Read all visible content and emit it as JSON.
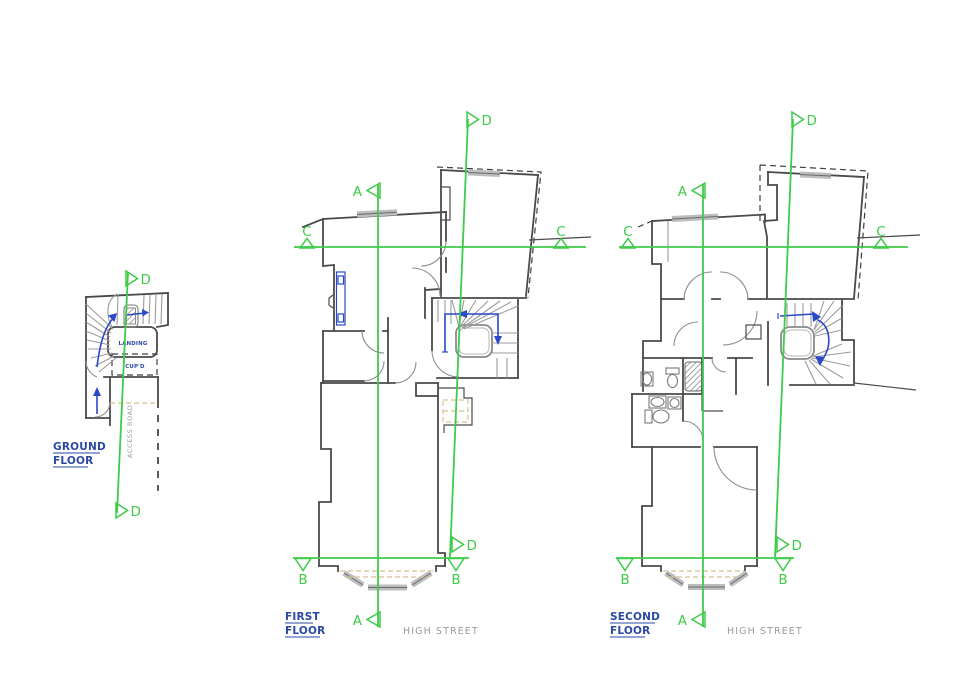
{
  "colors": {
    "section_green": "#3ecb49",
    "label_blue": "#2a49a5",
    "arrow_blue": "#2a49c8",
    "wall_gray": "#4a4a4a",
    "tread_gray": "#9b9b9b",
    "window_gray": "#bdbdbd",
    "tan_dash": "#d8c193",
    "street_gray": "#9a9a9a",
    "background": "#ffffff"
  },
  "ground_floor": {
    "title_1": "GROUND",
    "title_2": "FLOOR",
    "landing": "LANDING",
    "cupboard": "CUP'D",
    "road": "ACCESS ROAD",
    "d_top": "D",
    "d_bottom": "D"
  },
  "first_floor": {
    "title_1": "FIRST",
    "title_2": "FLOOR",
    "street": "HIGH STREET",
    "a_top": "A",
    "a_bottom": "A",
    "b_left": "B",
    "b_right": "B",
    "c_left": "C",
    "c_right": "C",
    "d_top": "D",
    "d_bottom": "D"
  },
  "second_floor": {
    "title_1": "SECOND",
    "title_2": "FLOOR",
    "street": "HIGH STREET",
    "a_top": "A",
    "a_bottom": "A",
    "b_left": "B",
    "b_right": "B",
    "c_left": "C",
    "c_right": "C",
    "d_top": "D",
    "d_bottom": "D"
  }
}
